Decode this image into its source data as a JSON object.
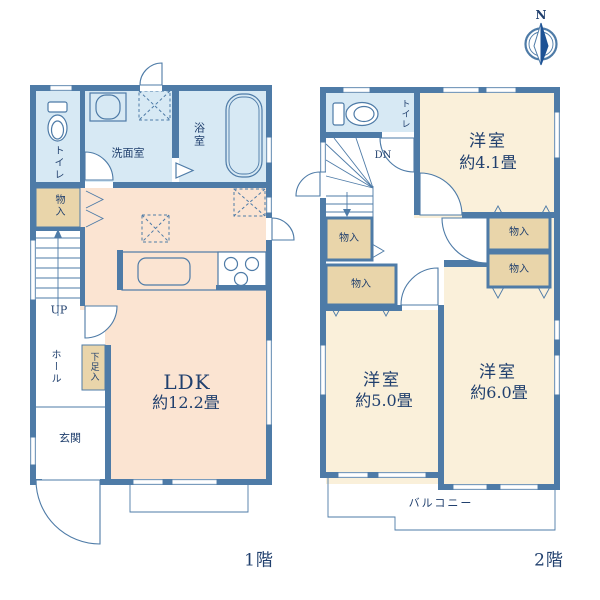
{
  "colors": {
    "wall": "#4e7ba7",
    "wet": "#d7e9f4",
    "ldk": "#fbe4d2",
    "bedroom": "#faf0da",
    "storage": "#e9d5aa",
    "text": "#21406e",
    "compass": "#1d5295"
  },
  "compass": {
    "north_label": "N"
  },
  "floor1": {
    "caption": "1階",
    "labels": {
      "toilet": "トイレ",
      "washroom": "洗面室",
      "bathroom": "浴室",
      "storage": "物入",
      "stairs_direction": "UP",
      "hall": "ホール",
      "shoe_storage": "下足入",
      "entrance": "玄関",
      "ldk_name": "LDK",
      "ldk_size": "約12.2畳"
    }
  },
  "floor2": {
    "caption": "2階",
    "labels": {
      "toilet": "トイレ",
      "stairs_direction": "DN",
      "bedroom_a_name": "洋室",
      "bedroom_a_size": "約4.1畳",
      "bedroom_b_name": "洋室",
      "bedroom_b_size": "約5.0畳",
      "bedroom_c_name": "洋室",
      "bedroom_c_size": "約6.0畳",
      "storage_nw": "物入",
      "storage_sw": "物入",
      "storage_ne_upper": "物入",
      "storage_ne_lower": "物入",
      "balcony": "バルコニー"
    }
  }
}
